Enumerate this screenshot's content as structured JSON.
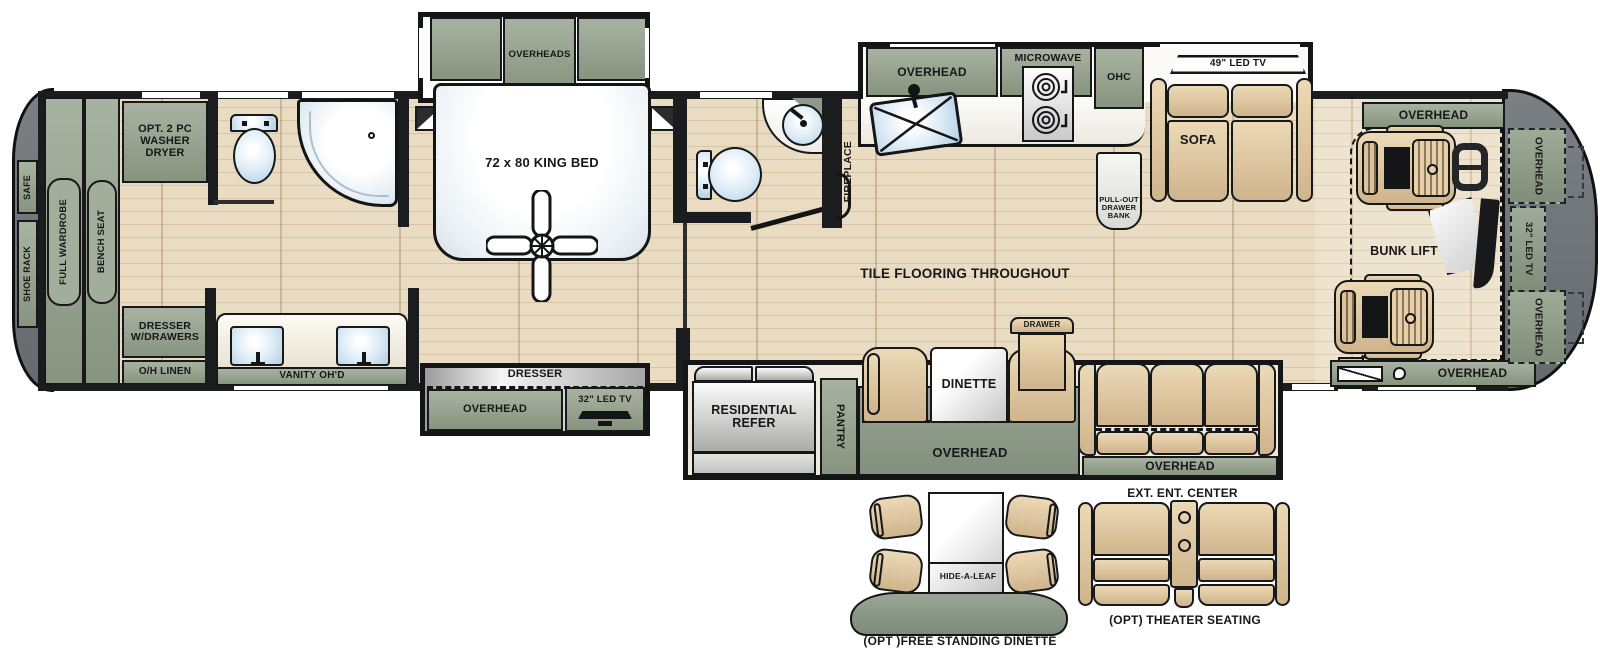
{
  "title": "RV Floor Plan",
  "labels": {
    "safe": "SAFE",
    "shoe_rack": "SHOE RACK",
    "full_wardrobe": "FULL WARDROBE",
    "bench_seat": "BENCH SEAT",
    "washer_dryer": "OPT. 2 PC\nWASHER\nDRYER",
    "dresser_w_drawers": "DRESSER\nW/DRAWERS",
    "oh_linen": "O/H LINEN",
    "vanity_ohd": "VANITY OH'D",
    "overheads": "OVERHEADS",
    "king_bed": "72 x 80 KING BED",
    "dresser": "DRESSER",
    "overhead": "OVERHEAD",
    "tv32": "32\" LED TV",
    "fireplace": "FIREPLACE",
    "microwave": "MICROWAVE",
    "ohc": "OHC",
    "pull_out_drawer_bank": "PULL-OUT\nDRAWER\nBANK",
    "tv49": "49\" LED TV",
    "sofa": "SOFA",
    "tile": "TILE FLOORING THROUGHOUT",
    "residential_refer": "RESIDENTIAL\nREFER",
    "pantry": "PANTRY",
    "dinette": "DINETTE",
    "drawer": "DRAWER",
    "ext_ent_center": "EXT. ENT. CENTER",
    "bunk_lift": "BUNK LIFT",
    "hide_a_leaf": "HIDE-A-LEAF",
    "opt_free_standing_dinette": "(OPT )FREE STANDING DINETTE",
    "opt_theater_seating": "(OPT) THEATER SEATING"
  },
  "colors": {
    "cabinet_green": "#93a08e",
    "floor_wood": "#e9dcc2",
    "end_cap_gray": "#6e7377",
    "furniture_tan": "#dcc4a0",
    "fixture_blue": "#c7dcec",
    "wall_black": "#1b1c1e"
  }
}
